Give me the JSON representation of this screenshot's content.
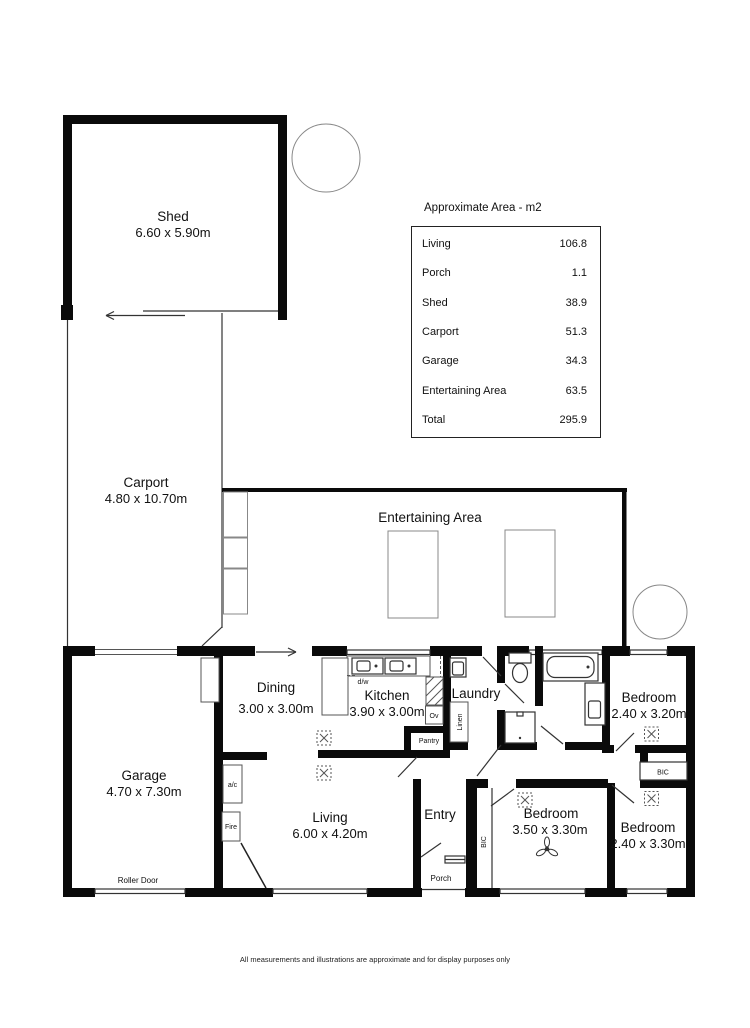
{
  "area_table": {
    "title": "Approximate Area - m2",
    "rows": [
      {
        "label": "Living",
        "value": "106.8"
      },
      {
        "label": "Porch",
        "value": "1.1"
      },
      {
        "label": "Shed",
        "value": "38.9"
      },
      {
        "label": "Carport",
        "value": "51.3"
      },
      {
        "label": "Garage",
        "value": "34.3"
      },
      {
        "label": "Entertaining Area",
        "value": "63.5"
      },
      {
        "label": "Total",
        "value": "295.9"
      }
    ]
  },
  "rooms": {
    "shed": {
      "name": "Shed",
      "dims": "6.60 x 5.90m"
    },
    "carport": {
      "name": "Carport",
      "dims": "4.80 x 10.70m"
    },
    "entertaining": {
      "name": "Entertaining Area"
    },
    "garage": {
      "name": "Garage",
      "dims": "4.70 x 7.30m"
    },
    "dining": {
      "name": "Dining",
      "dims": "3.00 x 3.00m"
    },
    "kitchen": {
      "name": "Kitchen",
      "dims": "3.90 x 3.00m"
    },
    "laundry": {
      "name": "Laundry"
    },
    "living": {
      "name": "Living",
      "dims": "6.00 x 4.20m"
    },
    "entry": {
      "name": "Entry"
    },
    "porch": {
      "name": "Porch"
    },
    "bedroom_top": {
      "name": "Bedroom",
      "dims": "2.40 x 3.20m"
    },
    "bedroom_mid": {
      "name": "Bedroom",
      "dims": "3.50 x 3.30m"
    },
    "bedroom_right": {
      "name": "Bedroom",
      "dims": "2.40 x 3.30m"
    }
  },
  "fixtures": {
    "roller_door": "Roller Door",
    "pantry": "Pantry",
    "linen": "Linen",
    "oven": "Ov",
    "dishwasher": "d/w",
    "aircon": "a/c",
    "fireplace": "Fire",
    "bic": "BIC"
  },
  "footer": "All measurements and illustrations are approximate and for display purposes only"
}
